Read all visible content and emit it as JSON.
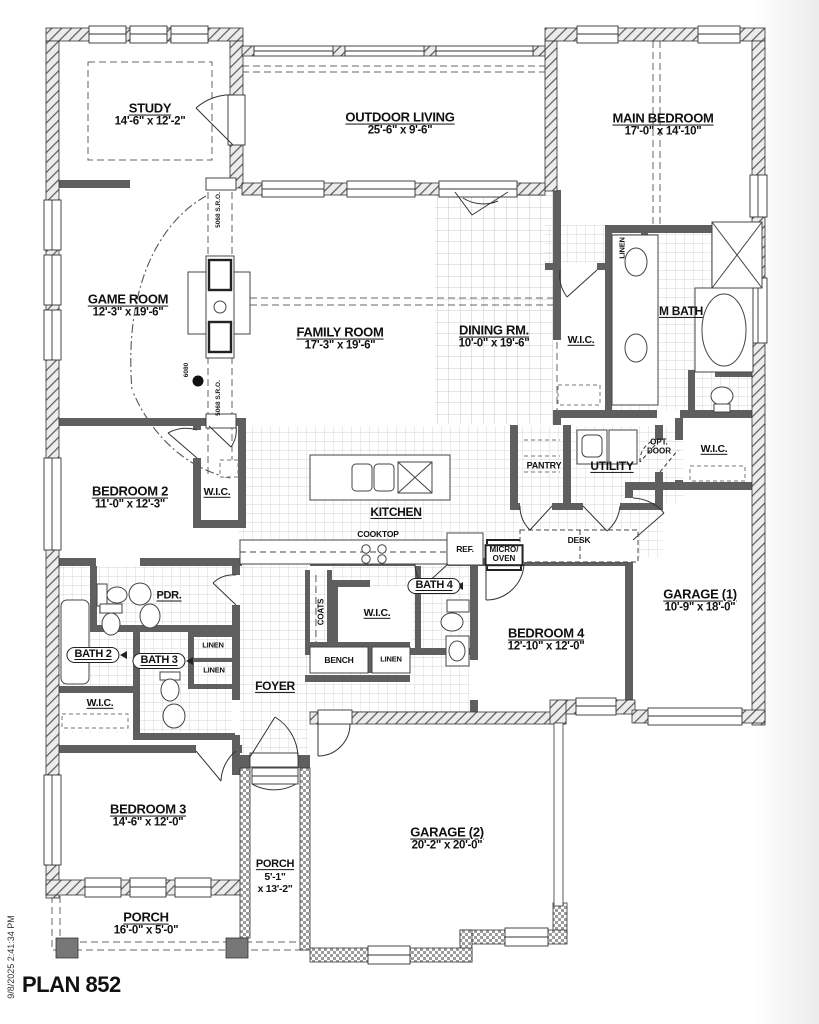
{
  "plan_title": "PLAN 852",
  "timestamp": "9/8/2025 2:41:34 PM",
  "rooms": {
    "study": {
      "name": "STUDY",
      "dims": "14'-6\" x 12'-2\""
    },
    "outdoor_living": {
      "name": "OUTDOOR LIVING",
      "dims": "25'-6\" x 9'-6\""
    },
    "main_bedroom": {
      "name": "MAIN BEDROOM",
      "dims": "17'-0\" x 14'-10\""
    },
    "game_room": {
      "name": "GAME ROOM",
      "dims": "12'-3\" x 19'-6\""
    },
    "family_room": {
      "name": "FAMILY ROOM",
      "dims": "17'-3\" x 19'-6\""
    },
    "dining_room": {
      "name": "DINING RM.",
      "dims": "10'-0\" x 19'-6\""
    },
    "kitchen": {
      "name": "KITCHEN"
    },
    "bedroom2": {
      "name": "BEDROOM 2",
      "dims": "11'-0\" x 12'-3\""
    },
    "bedroom3": {
      "name": "BEDROOM 3",
      "dims": "14'-6\" x 12'-0\""
    },
    "bedroom4": {
      "name": "BEDROOM 4",
      "dims": "12'-10\" x 12'-0\""
    },
    "garage1": {
      "name": "GARAGE (1)",
      "dims": "10'-9\" x 18'-0\""
    },
    "garage2": {
      "name": "GARAGE (2)",
      "dims": "20'-2\" x 20'-0\""
    },
    "porch_front": {
      "name": "PORCH",
      "dims": "16'-0\" x 5'-0\""
    },
    "porch_side": {
      "name": "PORCH",
      "dims_line1": "5'-1\"",
      "dims_line2": "x 13'-2\""
    },
    "m_bath": {
      "name": "M BATH"
    },
    "utility": {
      "name": "UTILITY"
    },
    "foyer": {
      "name": "FOYER"
    },
    "pdr": {
      "name": "PDR."
    },
    "bath2": {
      "name": "BATH 2"
    },
    "bath3": {
      "name": "BATH 3"
    },
    "bath4": {
      "name": "BATH 4"
    },
    "wic_main": {
      "name": "W.I.C."
    },
    "wic_right": {
      "name": "W.I.C."
    },
    "wic_bedroom2": {
      "name": "W.I.C."
    },
    "wic_hall": {
      "name": "W.I.C."
    },
    "wic_bedroom3": {
      "name": "W.I.C."
    }
  },
  "features": {
    "pantry": "PANTRY",
    "cooktop": "COOKTOP",
    "ref": "REF.",
    "micro_line1": "MICRO/",
    "micro_line2": "OVEN",
    "desk": "DESK",
    "coats": "COATS",
    "bench": "BENCH",
    "linen_main": "LINEN",
    "linen_hall_1": "LINEN",
    "linen_hall_2": "LINEN",
    "linen_bench": "LINEN",
    "opt_door_line1": "OPT.",
    "opt_door_line2": "DOOR"
  },
  "annotations": {
    "door_opening_study": "5068 S.R.O.",
    "door_opening_hall": "5068 S.R.O.",
    "opening_game": "6080"
  },
  "colors": {
    "wall": "#5f5f5f",
    "tile_line": "#c4c4c4",
    "text": "#111111"
  }
}
